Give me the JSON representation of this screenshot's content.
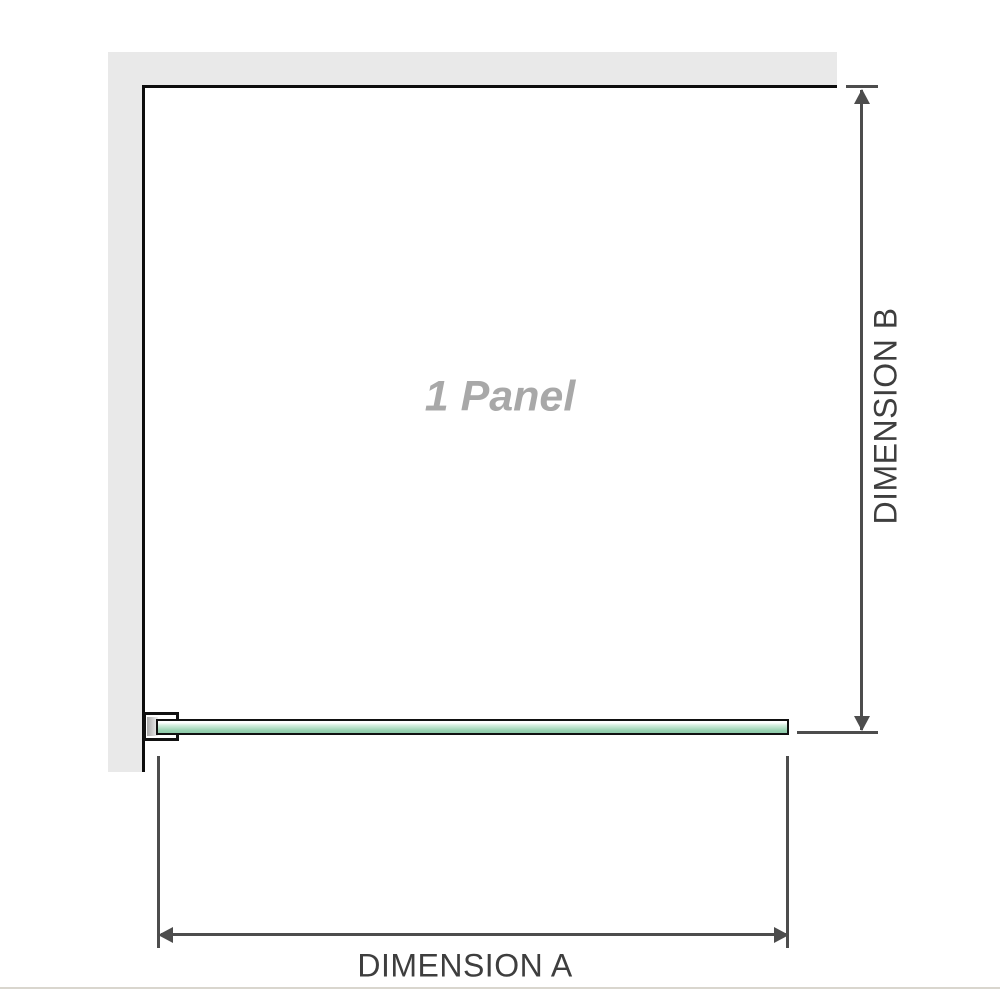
{
  "diagram": {
    "panel_label": "1 Panel",
    "dimension_a": {
      "label": "DIMENSION A"
    },
    "dimension_b": {
      "label": "DIMENSION B"
    }
  },
  "colors": {
    "background": "#ffffff",
    "wall_fill": "#e9e9e9",
    "wall_edge": "#0d0d0d",
    "glass_fill_light": "#d7efe0",
    "glass_fill_dark": "#97d1b0",
    "glass_border": "#111111",
    "bracket_border": "#111111",
    "bracket_metal": "#a9a9a9",
    "dimension_line": "#4d4d4d",
    "dimension_label_text": "#3e3e3e",
    "panel_label_text": "#a8a8a8",
    "footer_line": "#d9d6ce"
  }
}
